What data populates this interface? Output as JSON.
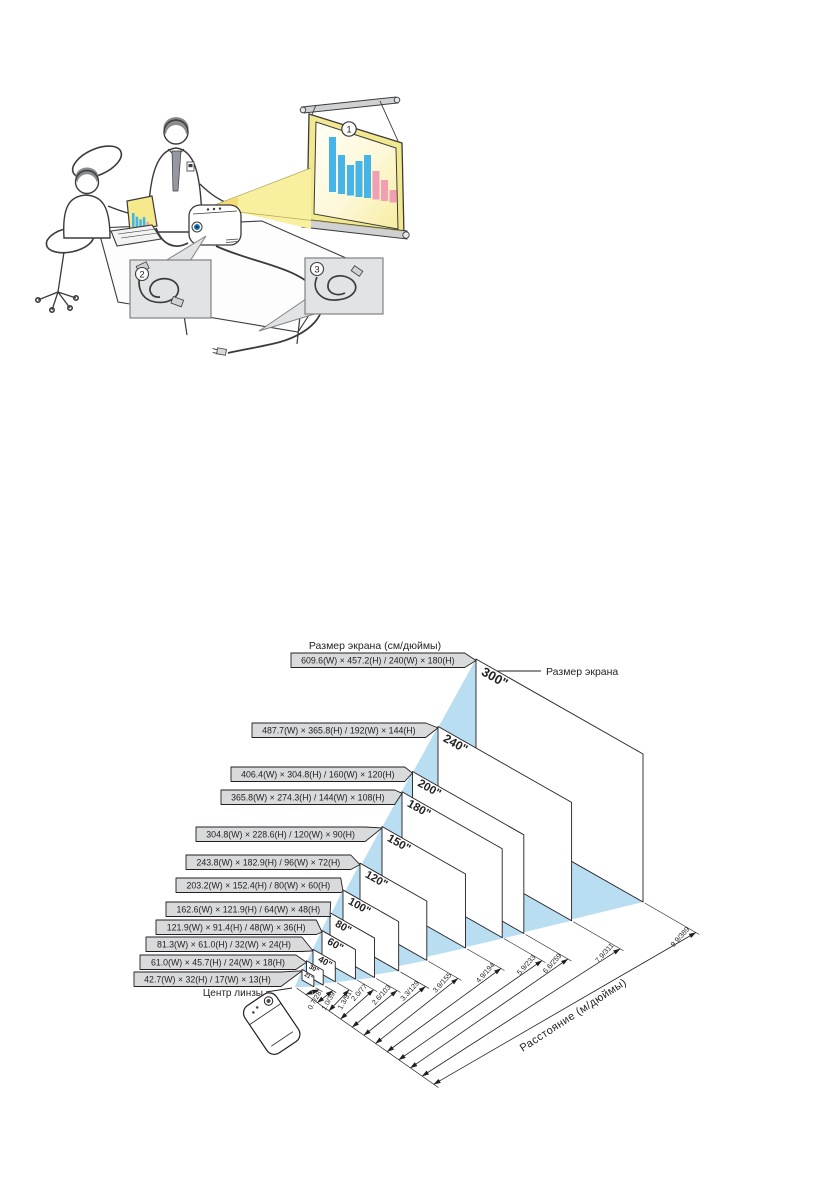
{
  "page": {
    "background": "#ffffff"
  },
  "illustration": {
    "callouts": [
      "1",
      "2",
      "3"
    ],
    "screen_chart_bars": {
      "x": [
        329,
        338,
        347,
        355.5,
        364,
        372.5,
        381,
        389.5
      ],
      "tops": [
        137,
        155,
        165,
        161,
        155,
        171,
        180,
        190
      ],
      "bottoms": [
        192,
        194,
        195.5,
        197,
        198,
        199.5,
        201,
        202.5
      ],
      "colors": [
        "blue",
        "blue",
        "blue",
        "blue",
        "blue",
        "pink",
        "pink",
        "pink"
      ]
    },
    "laptop_bars": {
      "heights": [
        14,
        11,
        9,
        12,
        8,
        6
      ],
      "colors": [
        "blue",
        "blue",
        "blue",
        "blue",
        "pink",
        "pink"
      ]
    },
    "colors": {
      "bar_blue": "#45b5e8",
      "bar_pink": "#f29fb4",
      "beam_yellow": "#f8f09e",
      "beam_bright": "#f5d96b",
      "screen_mat": "#f2e88f",
      "callout_box": "#e2e3e4",
      "outline": "#3b3b3c",
      "hair_gray": "#8a8c8e"
    }
  },
  "diagram": {
    "title": "Размер экрана (см/дюймы)",
    "size_callout": "Размер экрана",
    "lens_label": "Центр линзы",
    "axis_label": "Расстояние (м/дюймы)",
    "colors": {
      "beam": "#b9ddf1",
      "box_fill": "#d9dadb",
      "line": "#231f20"
    },
    "screens": [
      {
        "size": "21\"",
        "dims": "42.7(W) × 32(H) / 17(W) × 13(H)",
        "distance": "0.7/28"
      },
      {
        "size": "30\"",
        "dims": "61.0(W) × 45.7(H) / 24(W) × 18(H)",
        "distance": "1.0/39"
      },
      {
        "size": "40\"",
        "dims": "81.3(W) × 61.0(H) / 32(W) × 24(H)",
        "distance": "1.3/51"
      },
      {
        "size": "60\"",
        "dims": "121.9(W) × 91.4(H) / 48(W) × 36(H)",
        "distance": "2.0/77"
      },
      {
        "size": "80\"",
        "dims": "162.6(W) × 121.9(H) / 64(W) × 48(H)",
        "distance": "2.6/103"
      },
      {
        "size": "100\"",
        "dims": "203.2(W) × 152.4(H) / 80(W) × 60(H)",
        "distance": "3.3/129"
      },
      {
        "size": "120\"",
        "dims": "243.8(W) × 182.9(H) / 96(W) × 72(H)",
        "distance": "3.9/155"
      },
      {
        "size": "150\"",
        "dims": "304.8(W) × 228.6(H) / 120(W) × 90(H)",
        "distance": "4.9/194"
      },
      {
        "size": "180\"",
        "dims": "365.8(W) × 274.3(H) / 144(W) × 108(H)",
        "distance": "5.9/233"
      },
      {
        "size": "200\"",
        "dims": "406.4(W) × 304.8(H) / 160(W) × 120(H)",
        "distance": "6.6/259"
      },
      {
        "size": "240\"",
        "dims": "487.7(W) × 365.8(H) / 192(W) × 144(H)",
        "distance": "7.9/311"
      },
      {
        "size": "300\"",
        "dims": "609.6(W) × 457.2(H) / 240(W) × 180(H)",
        "distance": "9.9/389"
      }
    ]
  },
  "chart_data": {
    "type": "table",
    "title": "Размер экрана (см/дюймы)",
    "columns": [
      "Размер экрана (дюймы)",
      "см W×H",
      "дюймы W×H",
      "Расстояние (м/дюймы)"
    ],
    "rows": [
      [
        "21\"",
        "42.7 × 32",
        "17 × 13",
        "0.7/28"
      ],
      [
        "30\"",
        "61.0 × 45.7",
        "24 × 18",
        "1.0/39"
      ],
      [
        "40\"",
        "81.3 × 61.0",
        "32 × 24",
        "1.3/51"
      ],
      [
        "60\"",
        "121.9 × 91.4",
        "48 × 36",
        "2.0/77"
      ],
      [
        "80\"",
        "162.6 × 121.9",
        "64 × 48",
        "2.6/103"
      ],
      [
        "100\"",
        "203.2 × 152.4",
        "80 × 60",
        "3.3/129"
      ],
      [
        "120\"",
        "243.8 × 182.9",
        "96 × 72",
        "3.9/155"
      ],
      [
        "150\"",
        "304.8 × 228.6",
        "120 × 90",
        "4.9/194"
      ],
      [
        "180\"",
        "365.8 × 274.3",
        "144 × 108",
        "5.9/233"
      ],
      [
        "200\"",
        "406.4 × 304.8",
        "160 × 120",
        "6.6/259"
      ],
      [
        "240\"",
        "487.7 × 365.8",
        "192 × 144",
        "7.9/311"
      ],
      [
        "300\"",
        "609.6 × 457.2",
        "240 × 180",
        "9.9/389"
      ]
    ]
  }
}
